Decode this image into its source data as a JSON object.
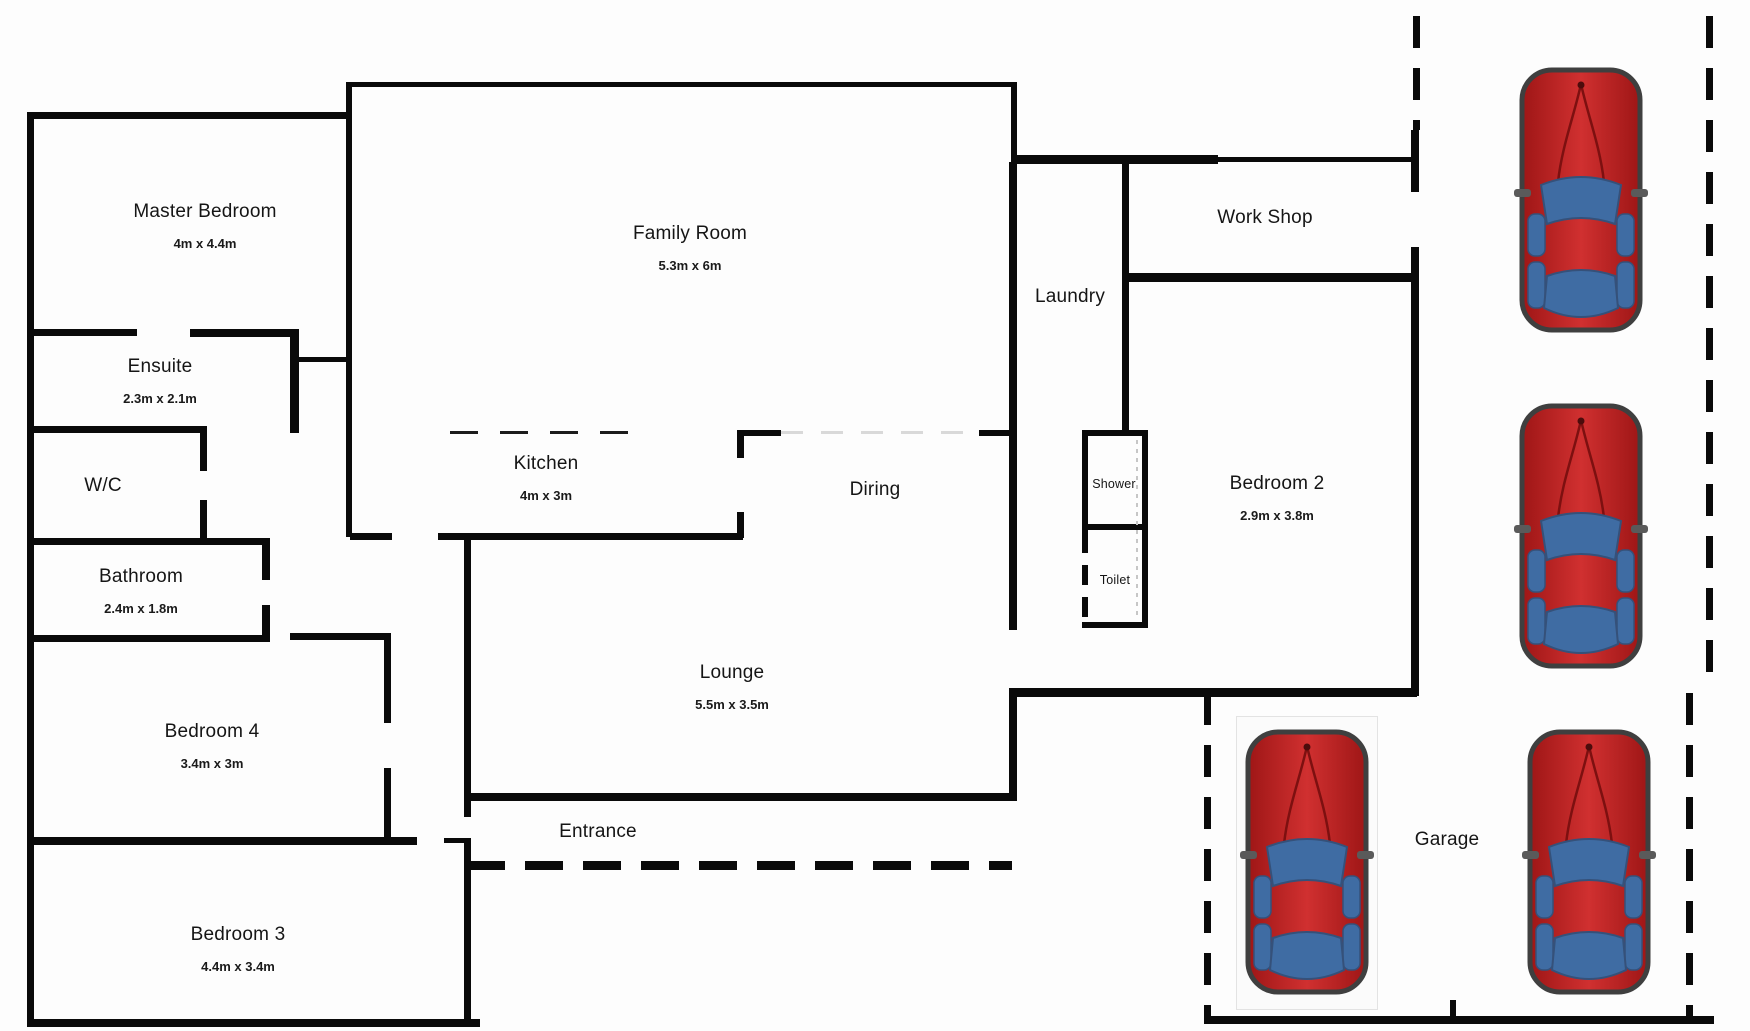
{
  "plan_title": "house floor plan",
  "rooms": [
    {
      "name": "Master Bedroom",
      "dims": "4m x 4.4m"
    },
    {
      "name": "Ensuite",
      "dims": "2.3m x 2.1m"
    },
    {
      "name": "W/C",
      "dims": ""
    },
    {
      "name": "Bathroom",
      "dims": "2.4m x 1.8m"
    },
    {
      "name": "Bedroom 4",
      "dims": "3.4m x 3m"
    },
    {
      "name": "Bedroom 3",
      "dims": "4.4m x 3.4m"
    },
    {
      "name": "Family Room",
      "dims": "5.3m x 6m"
    },
    {
      "name": "Kitchen",
      "dims": "4m x 3m"
    },
    {
      "name": "Diring",
      "dims": ""
    },
    {
      "name": "Lounge",
      "dims": "5.5m x 3.5m"
    },
    {
      "name": "Entrance",
      "dims": ""
    },
    {
      "name": "Laundry",
      "dims": ""
    },
    {
      "name": "Work Shop",
      "dims": ""
    },
    {
      "name": "Shower",
      "dims": ""
    },
    {
      "name": "Toilet",
      "dims": ""
    },
    {
      "name": "Bedroom 2",
      "dims": "2.9m x 3.8m"
    },
    {
      "name": "Garage",
      "dims": ""
    }
  ],
  "cars": {
    "count": 4,
    "locations": [
      "driveway-top",
      "driveway-middle",
      "garage-left",
      "garage-right"
    ],
    "body_color": "#c22020",
    "window_color": "#3f6ca3",
    "outline_color": "#3f3f3f"
  },
  "colors": {
    "wall": "#0a0a0a",
    "background": "#fdfdfd"
  }
}
